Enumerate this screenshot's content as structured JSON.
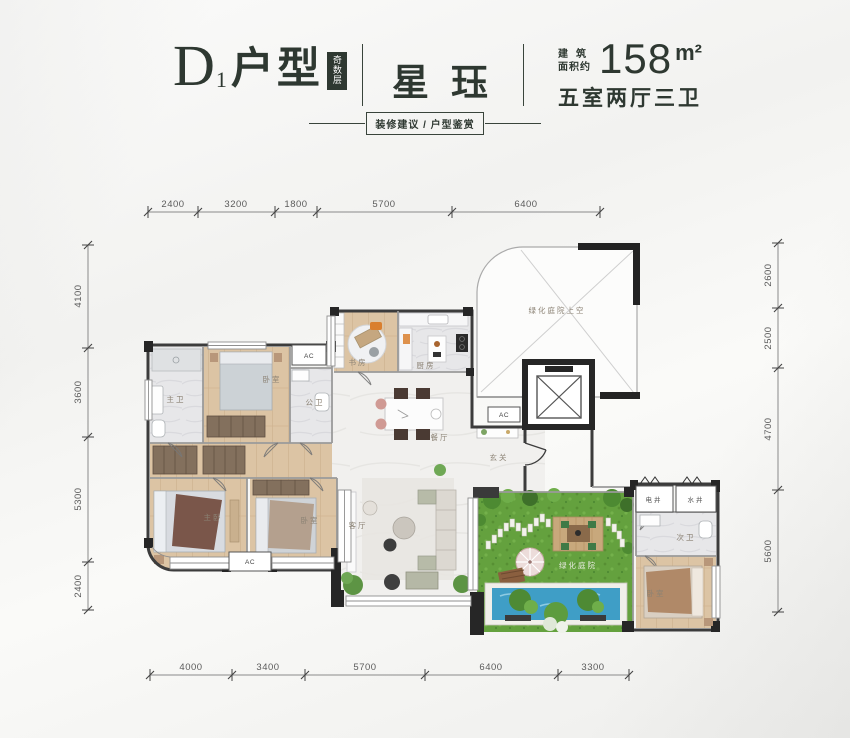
{
  "header": {
    "unit_letter": "D",
    "unit_number": "1",
    "unit_word": "户型",
    "floor_badge": "奇数层",
    "project_name": "星珏",
    "area_label_line1": "建筑",
    "area_label_line2": "面积约",
    "area_value": "158",
    "area_unit": "m²",
    "layout_summary": "五室两厅三卫",
    "subtitle": "装修建议 / 户型鉴赏"
  },
  "dimensions": {
    "top": [
      "2400",
      "3200",
      "1800",
      "5700",
      "6400"
    ],
    "bottom": [
      "4000",
      "3400",
      "5700",
      "6400",
      "3300"
    ],
    "left": [
      "4100",
      "3600",
      "5300",
      "2400"
    ],
    "right": [
      "2600",
      "2500",
      "4700",
      "5600"
    ]
  },
  "rooms": {
    "master_bath": "主卫",
    "bedroom_top": "卧室",
    "public_bath": "公卫",
    "study": "书房",
    "kitchen": "厨房",
    "dining": "餐厅",
    "foyer": "玄关",
    "living": "客厅",
    "master_bedroom": "主卧",
    "bedroom_middle": "卧室",
    "courtyard_void": "绿化庭院上空",
    "courtyard": "绿化庭院",
    "electric_shaft": "电井",
    "water_shaft": "水井",
    "second_bath": "次卫",
    "bedroom_right": "卧室",
    "ac_label": "AC"
  },
  "colors": {
    "accent": "#2e3831",
    "wood_floor": "#dcc4a4",
    "tile_floor": "#e7e7e9",
    "grass": "#64a13e",
    "pool": "#3f9ec6"
  }
}
